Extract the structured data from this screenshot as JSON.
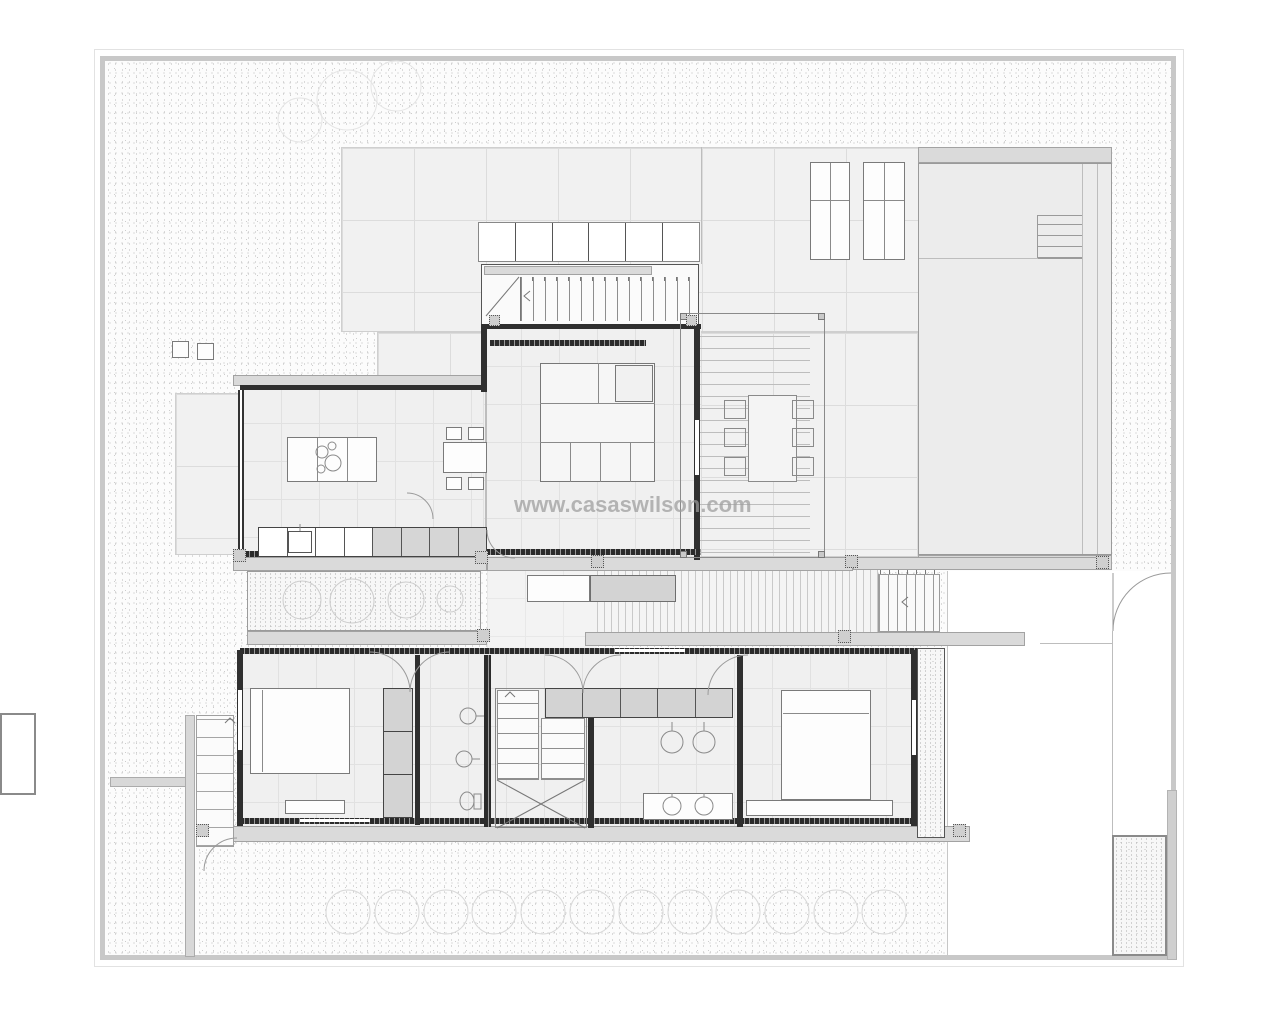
{
  "watermark": {
    "text": "www.casaswilson.com"
  },
  "palette": {
    "paper": "#ffffff",
    "boundary_line": "#c8c8c8",
    "wall": "#2f2f2f",
    "slab": "#dadada",
    "terrace_tile": "#f1f1f1",
    "interior_tile": "#f0f0f0",
    "pool_water": "#ececec",
    "wardrobe_fill": "#d3d3d3",
    "watermark_color": "#9c9c9c"
  }
}
